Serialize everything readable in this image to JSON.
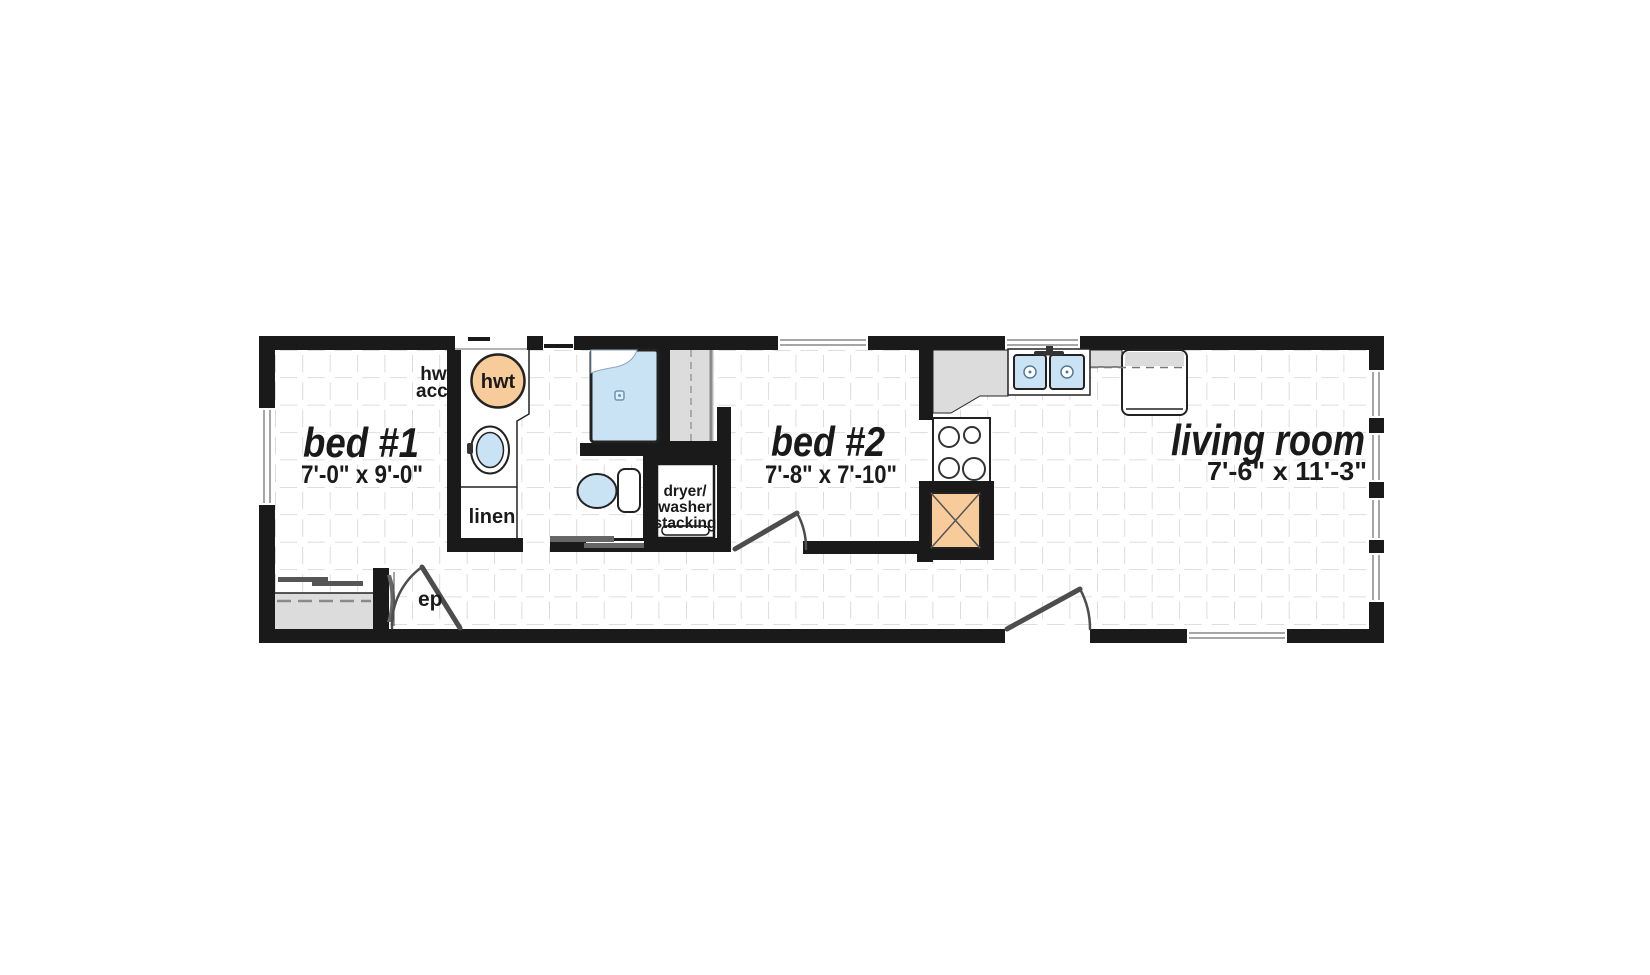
{
  "plan_type": "floor-plan",
  "rooms": {
    "bed1": {
      "name": "bed #1",
      "dims": "7'-0\" x 9'-0\""
    },
    "bed2": {
      "name": "bed #2",
      "dims": "7'-8\" x 7'-10\""
    },
    "living": {
      "name": "living room",
      "dims": "7'-6\" x 11'-3\""
    }
  },
  "labels": {
    "hwt_acc": {
      "line1": "hwt",
      "line2": "acc."
    },
    "hwt": "hwt",
    "linen": "linen",
    "laundry": {
      "line1": "dryer/",
      "line2": "washer",
      "line3": "stacking"
    },
    "ep": "ep"
  },
  "fixtures": [
    "shower",
    "toilet",
    "washer",
    "hot-water-tank",
    "double-sink",
    "stove",
    "refrigerator",
    "furnace",
    "linen-closet",
    "wardrobe-closet",
    "bed1-closet",
    "dryer-washer-stack"
  ],
  "colors": {
    "wall": "#1a1a1a",
    "fixture_blue": "#c9e3f5",
    "appliance_orange": "#f8cc9a",
    "counter_gray": "#dcdcdc",
    "closet_gray": "#dcdcdc",
    "grid_gray": "#c9c9c9",
    "door_gray": "#4d4d4d"
  }
}
